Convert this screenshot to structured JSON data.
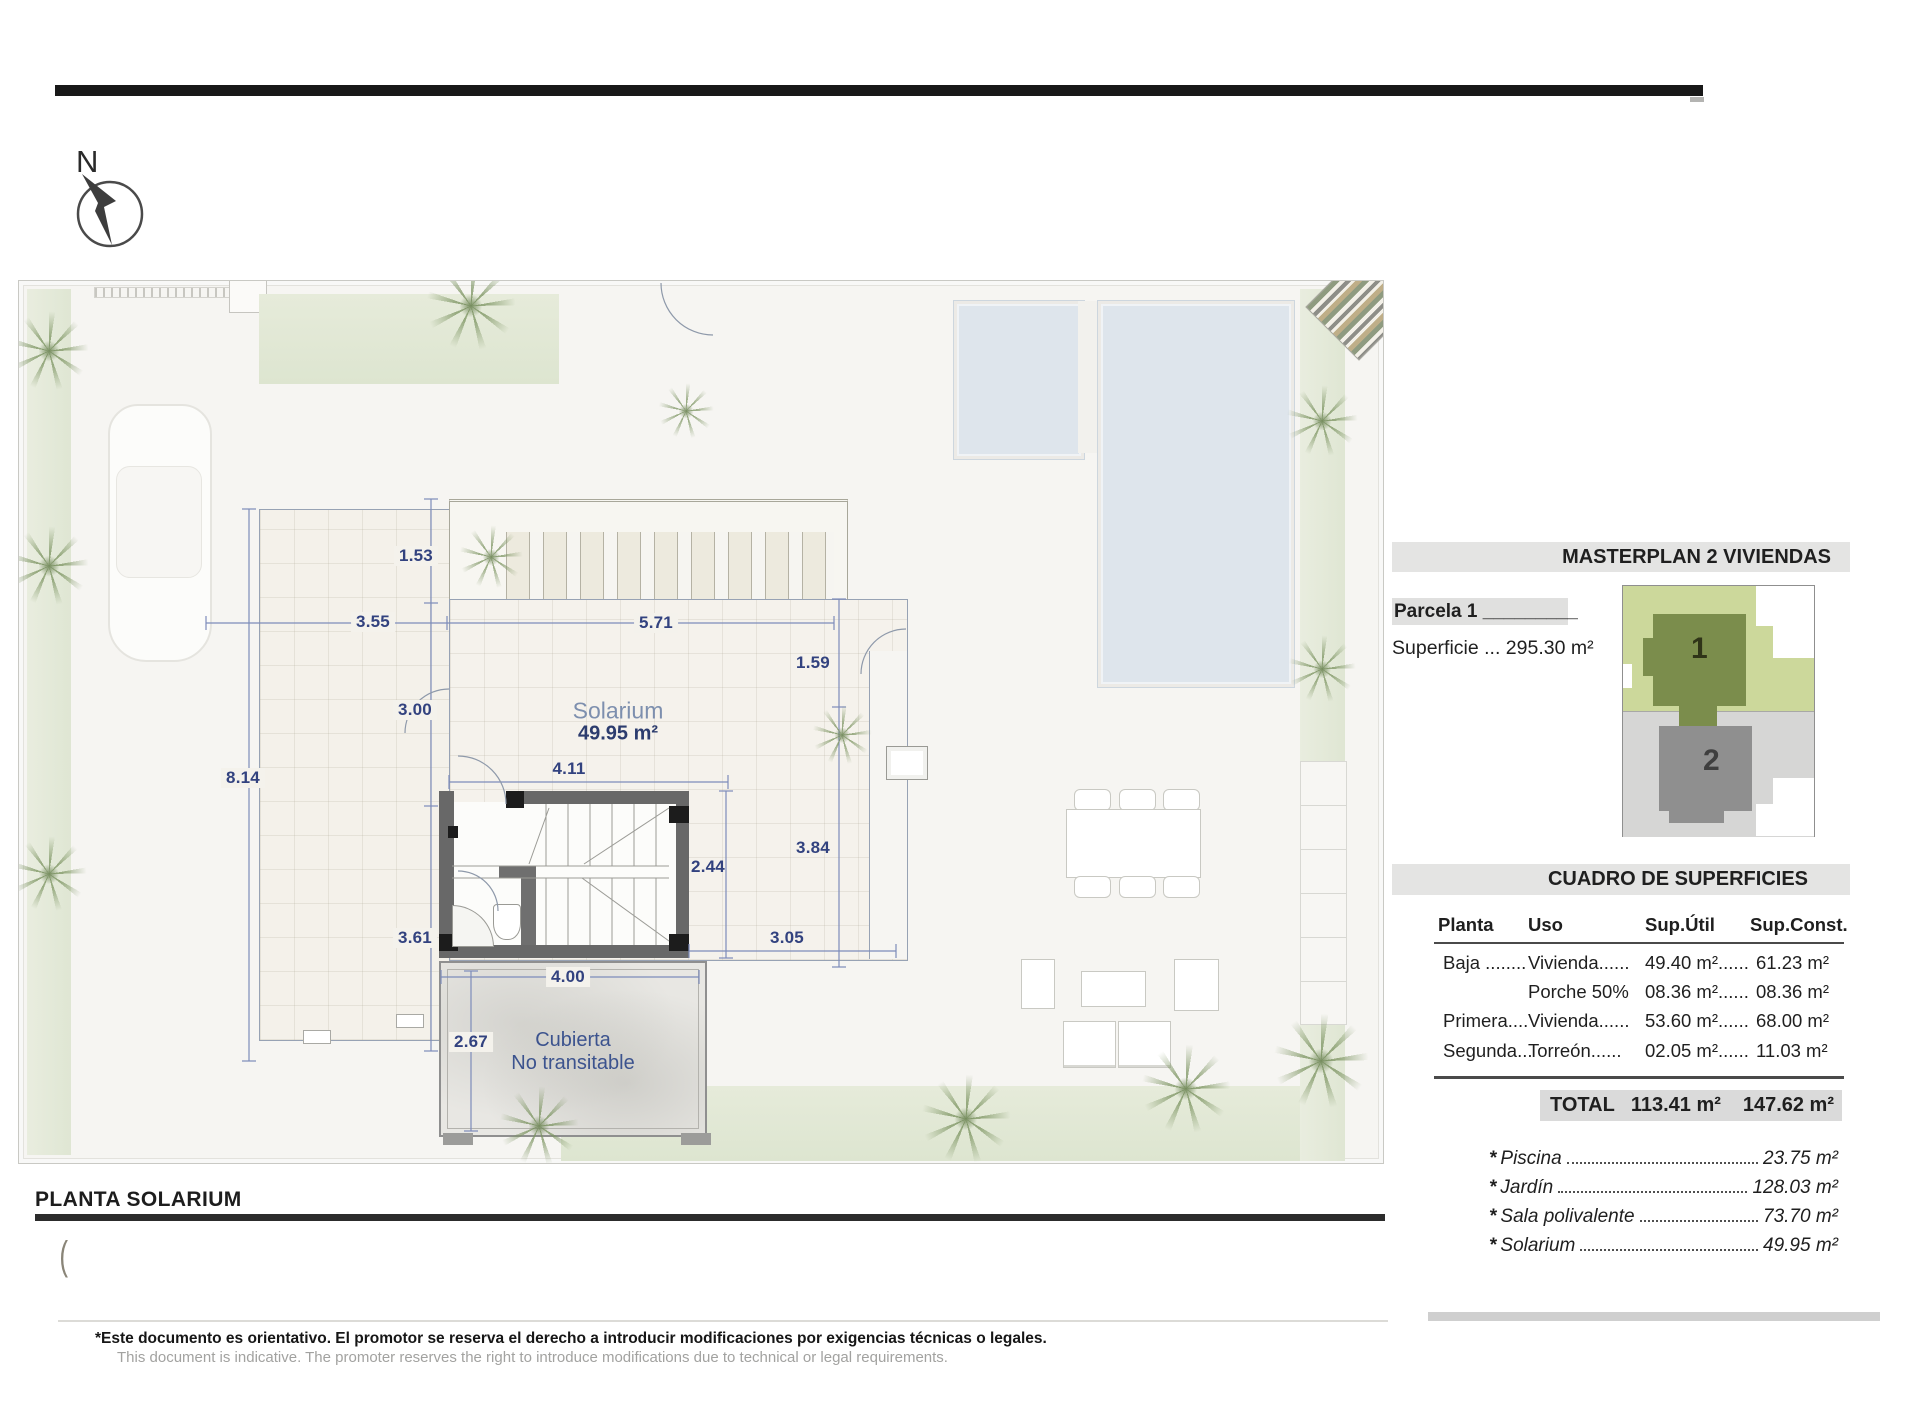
{
  "compass": {
    "label": "N"
  },
  "plan": {
    "title": "PLANTA SOLARIUM",
    "bracket": "(",
    "solarium_label": "Solarium",
    "solarium_area": "49.95 m²",
    "cubierta_line1": "Cubierta",
    "cubierta_line2": "No transitable",
    "dims": {
      "a": "1.53",
      "b": "3.55",
      "c": "5.71",
      "d": "1.59",
      "e": "3.00",
      "f": "8.14",
      "g": "4.11",
      "h": "2.44",
      "i": "3.84",
      "j": "3.61",
      "k": "3.05",
      "l": "4.00",
      "m": "2.67"
    }
  },
  "panel": {
    "masterplan_title": "MASTERPLAN 2 VIVIENDAS",
    "parcela_label": "Parcela 1",
    "parcela_underscore": "_________",
    "superficie": "Superficie ... 295.30 m²",
    "map": {
      "house1": "1",
      "house2": "2"
    },
    "table": {
      "title": "CUADRO DE SUPERFICIES",
      "headers": [
        "Planta",
        "Uso",
        "Sup.Útil",
        "Sup.Const."
      ],
      "rows": [
        {
          "planta": "Baja ........",
          "uso": "Vivienda......",
          "util": "49.40 m²......",
          "const": "61.23 m²"
        },
        {
          "planta": "",
          "uso": "Porche 50%",
          "util": "08.36 m²......",
          "const": "08.36 m²"
        },
        {
          "planta": "Primera....",
          "uso": "Vivienda......",
          "util": "53.60 m²......",
          "const": "68.00 m²"
        },
        {
          "planta": "Segunda...",
          "uso": "Torreón......",
          "util": "02.05 m²......",
          "const": "11.03 m²"
        }
      ],
      "total_label": "TOTAL",
      "total_util": "113.41 m²",
      "total_const": "147.62 m²"
    },
    "extras": [
      {
        "star": "*",
        "label": "Piscina",
        "value": "23.75 m²"
      },
      {
        "star": "*",
        "label": "Jardín",
        "value": "128.03 m²"
      },
      {
        "star": "*",
        "label": "Sala polivalente",
        "value": "73.70 m²"
      },
      {
        "star": "*",
        "label": "Solarium",
        "value": "49.95 m²"
      }
    ]
  },
  "footer": {
    "line1": "*Este documento es orientativo. El promotor se reserva el derecho a introducir modificaciones por exigencias técnicas o legales.",
    "line2": "This document is indicative. The promoter reserves the right to introduce modifications due to technical or legal requirements."
  },
  "colors": {
    "dim_blue": "#32427f",
    "band_gray": "#e4e4e3",
    "pool_blue": "#dee5ec",
    "parcel_green": "#ccd89b",
    "parcel_gray": "#d6d6d5",
    "house1_green": "#7b8d4c",
    "house2_gray": "#8f8f8f"
  }
}
